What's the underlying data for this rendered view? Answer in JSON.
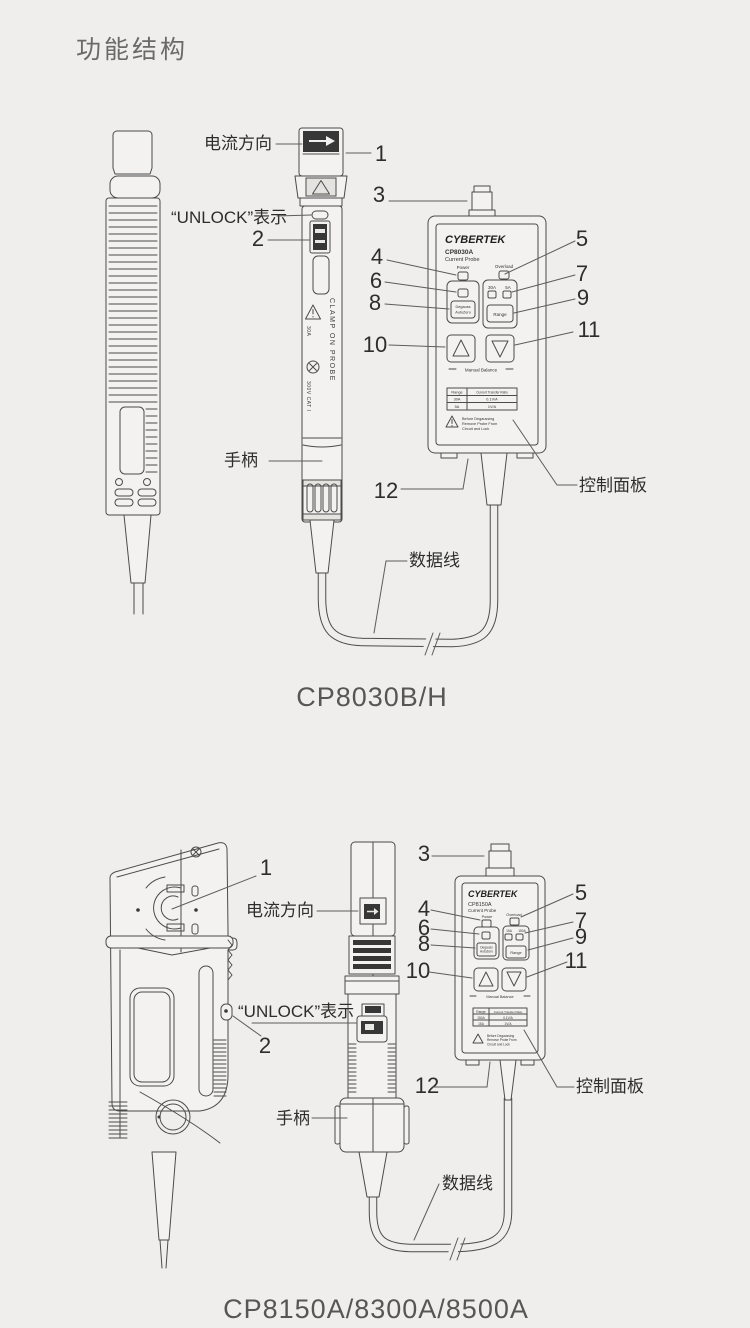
{
  "page": {
    "title": "功能结构"
  },
  "fig1": {
    "caption": "CP8030B/H",
    "callouts": {
      "current_direction": "电流方向",
      "unlock": "“UNLOCK”表示",
      "handle": "手柄",
      "control_panel": "控制面板",
      "data_cable": "数据线"
    },
    "numbers": {
      "n1": "1",
      "n2": "2",
      "n3": "3",
      "n4": "4",
      "n5": "5",
      "n6": "6",
      "n7": "7",
      "n8": "8",
      "n9": "9",
      "n10": "10",
      "n11": "11",
      "n12": "12"
    },
    "probe": {
      "clamp_text": "CLAMP ON PROBE",
      "mark_current": "30A",
      "mark_voltage": "300V CAT I"
    },
    "panel": {
      "brand": "CYBERTEK",
      "model": "CP8030A",
      "type": "Current Probe",
      "power": "Power",
      "overload": "Overload",
      "range_a": "30A",
      "range_b": "5A",
      "degauss_1": "Degauss",
      "degauss_2": "AutoZero",
      "range_button": "Range",
      "manual_balance": "Manual Balance",
      "table": {
        "col_range": "Range",
        "col_ratio": "Current Transfer Ratio",
        "rows": [
          [
            "30A",
            "0.1V/A"
          ],
          [
            "5A",
            "1V/A"
          ]
        ]
      },
      "warning": [
        "Before Degaussing",
        "Remove Probe From",
        "Circuit and Lock"
      ]
    }
  },
  "fig2": {
    "caption": "CP8150A/8300A/8500A",
    "callouts": {
      "current_direction": "电流方向",
      "unlock": "“UNLOCK”表示",
      "handle": "手柄",
      "control_panel": "控制面板",
      "data_cable": "数据线"
    },
    "numbers": {
      "n1": "1",
      "n2": "2",
      "n3": "3",
      "n4": "4",
      "n5": "5",
      "n6": "6",
      "n7": "7",
      "n8": "8",
      "n9": "9",
      "n10": "10",
      "n11": "11",
      "n12": "12"
    },
    "panel": {
      "brand": "CYBERTEK",
      "model": "CP8150A",
      "type": "Current Probe",
      "power": "Power",
      "overload": "Overload",
      "range_a": "15A",
      "range_b": "150A",
      "degauss_1": "Degauss",
      "degauss_2": "AutoZero",
      "range_button": "Range",
      "manual_balance": "Manual Balance",
      "table": {
        "col_range": "Range",
        "col_ratio": "Current Transfer Ratio",
        "rows": [
          [
            "150A",
            "0.1V/A"
          ],
          [
            "15A",
            "1V/A"
          ]
        ]
      },
      "warning": [
        "Before Degaussing",
        "Remove Probe From",
        "Circuit and Lock"
      ]
    }
  }
}
